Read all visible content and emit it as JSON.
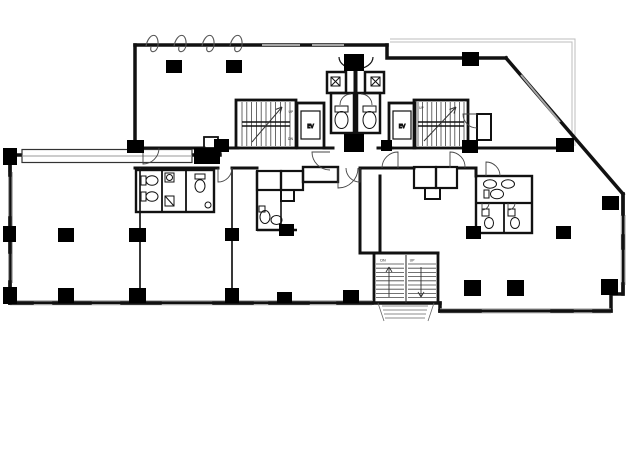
{
  "plan": {
    "labels": {
      "elevator": "EV",
      "up": "UP",
      "down": "DN"
    },
    "colors": {
      "wall": "#111111",
      "column": "#000000",
      "thin_line": "#3a3a3a",
      "window_line": "#a6a6a6",
      "canopy_line": "#bdbdbd",
      "background": "#ffffff",
      "label_text": "#222222"
    },
    "icons": [
      {
        "name": "toilet-icon",
        "meaning": "toilet fixture"
      },
      {
        "name": "sink-icon",
        "meaning": "wash basin"
      },
      {
        "name": "fan-icon",
        "meaning": "ventilation / pipe shaft"
      },
      {
        "name": "door-arc-icon",
        "meaning": "door swing arc"
      },
      {
        "name": "window-curl-icon",
        "meaning": "awning window symbol"
      },
      {
        "name": "stair-arrow-icon",
        "meaning": "stair direction arrow"
      }
    ],
    "counts": {
      "stairwells": 3,
      "elevators": 2,
      "toilet_blocks": 4
    }
  }
}
